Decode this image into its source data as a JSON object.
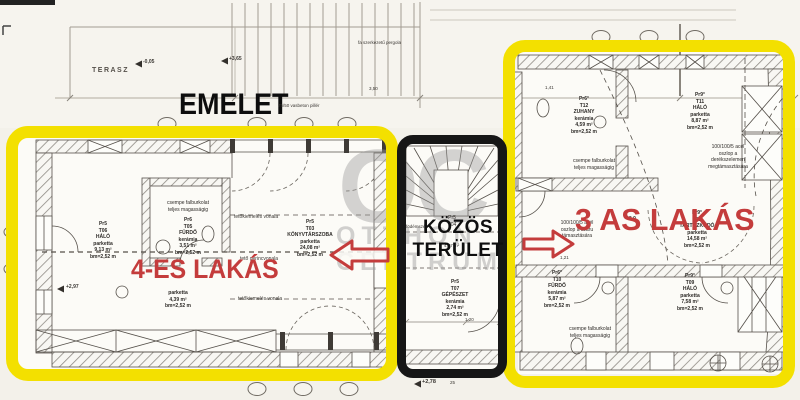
{
  "colors": {
    "highlight_yellow": "#f3e000",
    "outline_black": "#161616",
    "label_red": "#c43c3c"
  },
  "top": {
    "terasz": "TERASZ",
    "emelet": "EMELET",
    "pillar_note": "75/50 vasbeton pillér",
    "pergola_note": "fa szerkezetű pergola",
    "level_a": "-0,05",
    "level_b": "+3,65",
    "dim_350": "3,50"
  },
  "apartment4": {
    "title": "4-ES LAKÁS",
    "halo": [
      "Pr5",
      "T06",
      "HÁLÓ",
      "parketta",
      "9,13 m²",
      "bm=2,52 m"
    ],
    "furdo": [
      "Pr6",
      "T05",
      "FÜRDŐ",
      "kerámia",
      "3,51 m²",
      "bm=2,52 m"
    ],
    "konyvtarszoba": [
      "Pr5",
      "T03",
      "KÖNYVTÁRSZOBA",
      "parketta",
      "24,08 m²",
      "bm=2,52 m"
    ],
    "eloter": [
      "parketta",
      "4,39 m²",
      "bm=2,52 m"
    ],
    "csempe_note": [
      "csempe falburkolat",
      "teljes magasságig"
    ],
    "tetokiemeles_1": "tetőkiemelés vonala",
    "gerinc": "tető gerincvonala",
    "tetokiemeles_2": "tetőkiemelés vonala",
    "level": "+2,97"
  },
  "common": {
    "title": [
      "KÖZÖS",
      "TERÜLET"
    ],
    "stair_tag": [
      "Pr5",
      "T04"
    ],
    "stair_area": "4,87 m²",
    "fodemszel": "födémszél",
    "gepeszet": [
      "Pr5",
      "T07",
      "GÉPÉSZET",
      "kerámia",
      "2,74 m²",
      "bm=2,52 m"
    ],
    "level": "+2,78",
    "dim_25": "25",
    "dim_120": "1,20"
  },
  "apartment3": {
    "title": "3 AS LAKÁS",
    "zuhany": [
      "Pr6°",
      "T12",
      "ZUHANY",
      "kerámia",
      "4,59 m²",
      "bm=2,52 m"
    ],
    "halo_t11": [
      "Pr9°",
      "T11",
      "HÁLÓ",
      "parketta",
      "8,87 m²",
      "bm=2,52 m"
    ],
    "oszlop_note_1": [
      "100/100/5 acél",
      "oszlop a",
      "derékszelemen",
      "megtámasztására"
    ],
    "oszlop_note_2": [
      "100/100/5 acél",
      "oszlop a szaru",
      "támasztására"
    ],
    "csempe_note_1": [
      "csempe falburkolat",
      "teljes magasságig"
    ],
    "tartozkodo": [
      "Pr9°",
      "T08",
      "TARTÓZKODÓ",
      "parketta",
      "14,58 m²",
      "bm=2,52 m"
    ],
    "furdo_t10": [
      "Pr6°",
      "T10",
      "FÜRDŐ",
      "kerámia",
      "5,87 m²",
      "bm=2,52 m"
    ],
    "halo_t09": [
      "Pr9°",
      "T09",
      "HÁLÓ",
      "parketta",
      "7,58 m²",
      "bm=2,52 m"
    ],
    "csempe_note_2": [
      "csempe falburkolat",
      "teljes magasságig"
    ],
    "level": "+3,9",
    "dim_141": "1,41",
    "dim_121": "1,21"
  },
  "watermark": {
    "oc": "OC",
    "line1": "OTTHON",
    "line2": "CENTRUM"
  }
}
